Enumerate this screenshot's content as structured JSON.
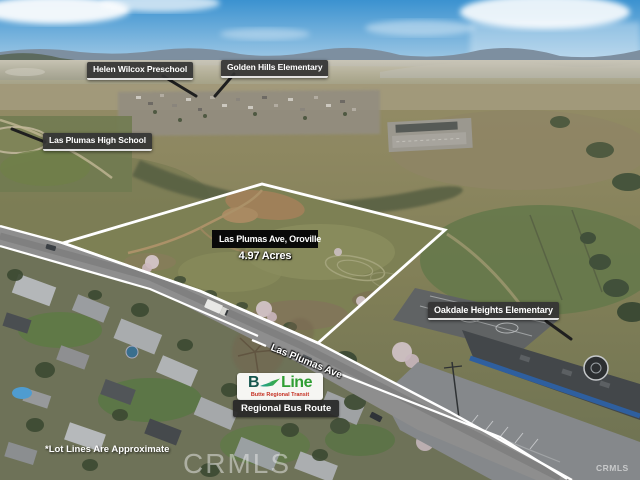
{
  "property": {
    "address": "Las Plumas Ave, Oroville",
    "acreage": "4.97 Acres"
  },
  "nearby_labels": {
    "preschool": "Helen Wilcox Preschool",
    "elementary_north": "Golden Hills Elementary",
    "high_school": "Las Plumas High School",
    "elementary_south": "Oakdale Heights Elementary"
  },
  "street": {
    "name": "Las Plumas Ave"
  },
  "transit": {
    "brand_initial": "B",
    "brand_name": "Line",
    "agency": "Butte Regional Transit",
    "route_label": "Regional Bus Route"
  },
  "footnote": "*Lot Lines Are Approximate",
  "watermarks": {
    "center": "CRMLS",
    "corner": "CRMLS"
  },
  "colors": {
    "lot_outline": "#ffffff",
    "callout_box": "#343434",
    "title_box": "#090909",
    "bline_b": "#17564e",
    "bline_line": "#2f9e33",
    "bline_agency": "#c53022",
    "route_box": "#282828"
  }
}
